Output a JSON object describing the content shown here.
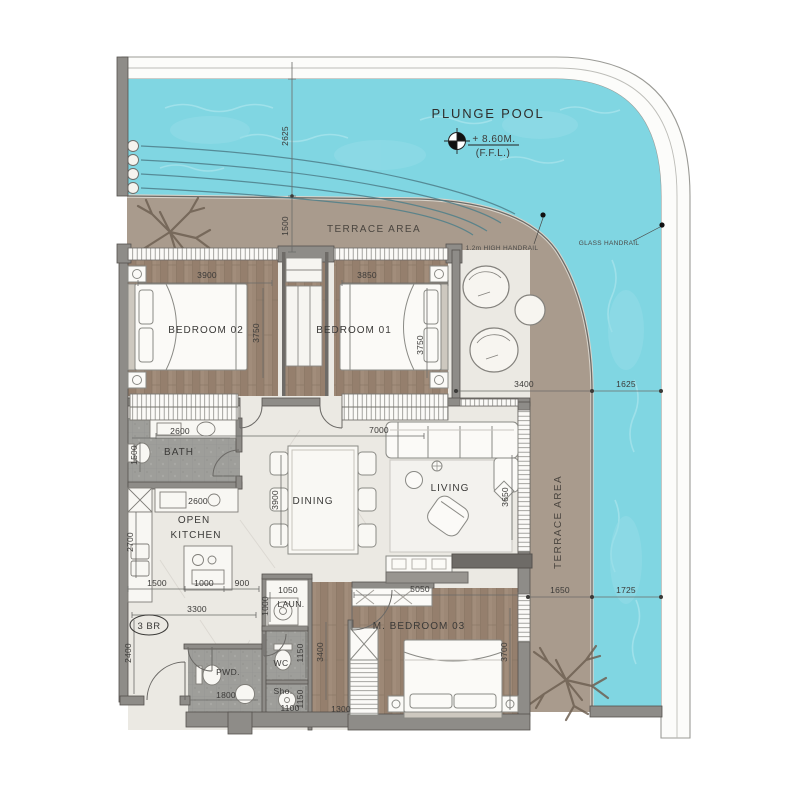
{
  "colors": {
    "pool": "#80d6e2",
    "pool_light": "#abe7ee",
    "terrace": "#a99b8d",
    "wood": "#9c8775",
    "tile": "#9d9d99",
    "marble": "#ebe9e3",
    "wall": "#8e8c88",
    "wall_dark": "#55524e",
    "text": "#3b3a38"
  },
  "labels": {
    "pool_title": "PLUNGE POOL",
    "pool_level": "+ 8.60M.",
    "pool_ffl": "(F.F.L.)",
    "terrace_top": "TERRACE AREA",
    "terrace_right": "TERRACE AREA",
    "handrail": "1.2m HIGH HANDRAIL",
    "glass_handrail": "GLASS HANDRAIL",
    "badge": "3 BR",
    "bedroom02": "BEDROOM 02",
    "bedroom01": "BEDROOM 01",
    "bath": "BATH",
    "kitchen1": "OPEN",
    "kitchen2": "KITCHEN",
    "dining": "DINING",
    "living": "LIVING",
    "master": "M. BEDROOM 03",
    "pwd": "PWD.",
    "wc": "WC",
    "shower": "Sho.",
    "laundry": "LAUN."
  },
  "dims": {
    "pool_top": "2625",
    "terrace_top": "1500",
    "b02_w": "3900",
    "b01_w": "3850",
    "b02_d": "3750",
    "b01_d": "3750",
    "lounge_w": "3400",
    "pool_r_top": "1625",
    "terrace_r": "1650",
    "pool_r_bot": "1725",
    "bath_w": "2600",
    "bath_d": "1500",
    "counter": "2600",
    "kitchen_d": "2700",
    "k1": "1500",
    "k2": "1000",
    "k3": "900",
    "entry_w": "3300",
    "entry_d": "2400",
    "laundry_w": "1050",
    "laundry_d": "1000",
    "pwd_w": "1800",
    "wc_d": "1150",
    "sho_d": "1150",
    "sho_w": "1100",
    "hall_d": "3400",
    "closet_w": "1300",
    "mbr_w": "5050",
    "mbr_d": "3700",
    "dining_w": "7000",
    "dining_d": "3900",
    "living_d": "3650"
  }
}
